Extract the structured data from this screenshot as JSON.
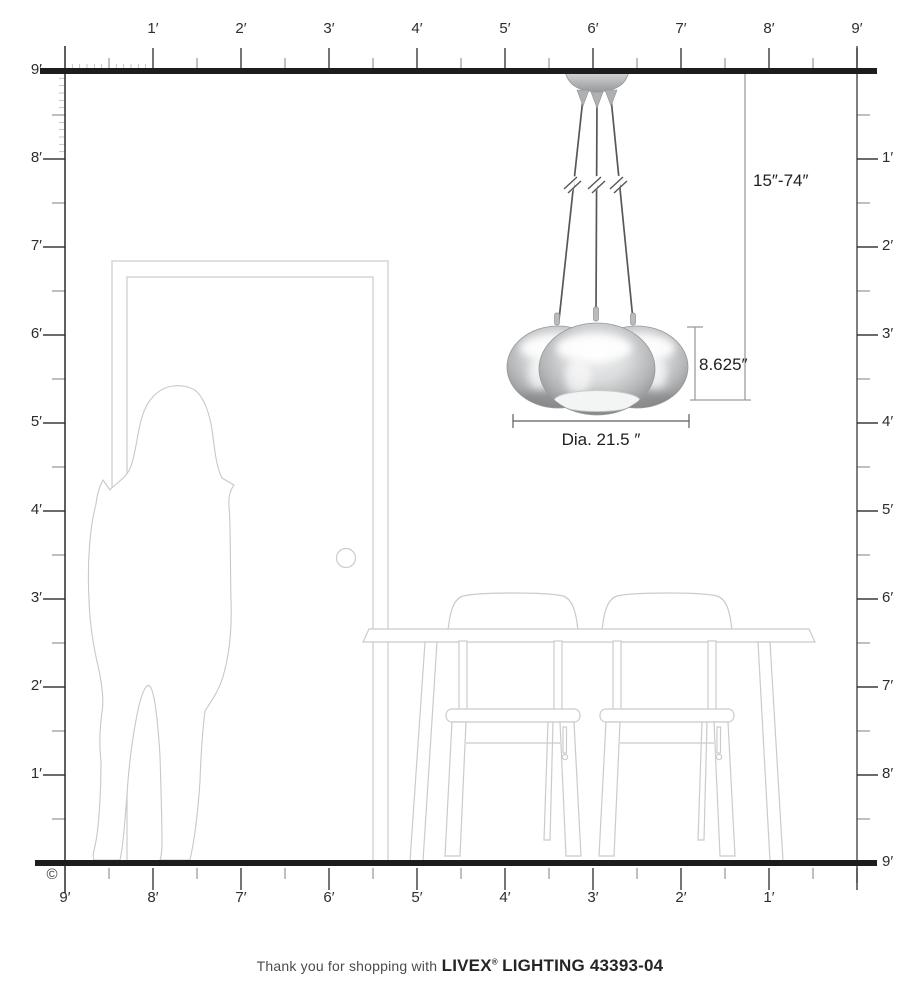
{
  "page_title": "Livex Lighting pendant scale diagram",
  "diagram": {
    "type": "product-dimension-diagram",
    "room": {
      "width_label": "9 ft",
      "height_label": "9 ft"
    },
    "rulers": {
      "top": {
        "labels": [
          "1′",
          "2′",
          "3′",
          "4′",
          "5′",
          "6′",
          "7′",
          "8′",
          "9′"
        ]
      },
      "left": {
        "labels": [
          "9′",
          "8′",
          "7′",
          "6′",
          "5′",
          "4′",
          "3′",
          "2′",
          "1′"
        ]
      },
      "right": {
        "labels": [
          "1′",
          "2′",
          "3′",
          "4′",
          "5′",
          "6′",
          "7′",
          "8′",
          "9′"
        ]
      },
      "bottom": {
        "labels": [
          "9′",
          "8′",
          "7′",
          "6′",
          "5′",
          "4′",
          "3′",
          "2′",
          "1′"
        ]
      }
    },
    "dimensions": {
      "hanging_range": "15″-74″",
      "fixture_height": "8.625″",
      "fixture_diameter": "Dia. 21.5 ″"
    },
    "fixture": {
      "shade_count": 3,
      "finish": "chrome"
    },
    "scene_items": [
      "person-silhouette",
      "door",
      "dining-table",
      "chair",
      "chair",
      "pendant-light"
    ],
    "copyright_symbol": "©"
  },
  "footer": {
    "thanks_text": "Thank you for shopping with",
    "brand": "LIVEX",
    "registered_mark": "®",
    "product": "LIGHTING 43393-04"
  },
  "colors": {
    "structure_line": "#1d1d1f",
    "ruler_major_tick": "#3c3c3e",
    "ruler_minor_tick": "#939598",
    "furniture_outline": "#c9cbcd",
    "cord": "#55575a",
    "dimension_line": "#9b9d9f",
    "chrome_light": "#f2f3f4",
    "chrome_dark": "#85878a"
  }
}
